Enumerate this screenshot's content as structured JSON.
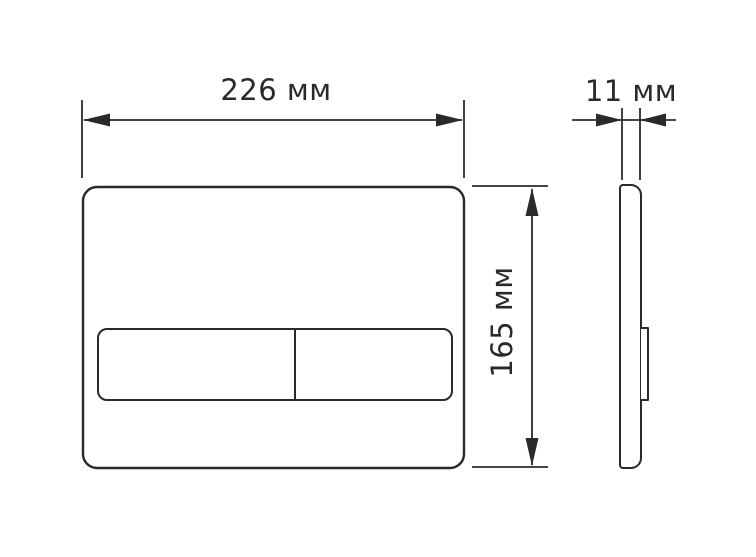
{
  "diagram": {
    "type": "technical-drawing",
    "labels": {
      "width": "226 мм",
      "depth": "11 мм",
      "height": "165 мм"
    },
    "values": {
      "width_mm": 226,
      "depth_mm": 11,
      "height_mm": 165
    },
    "colors": {
      "line": "#2c2a29",
      "background": "#ffffff"
    }
  }
}
